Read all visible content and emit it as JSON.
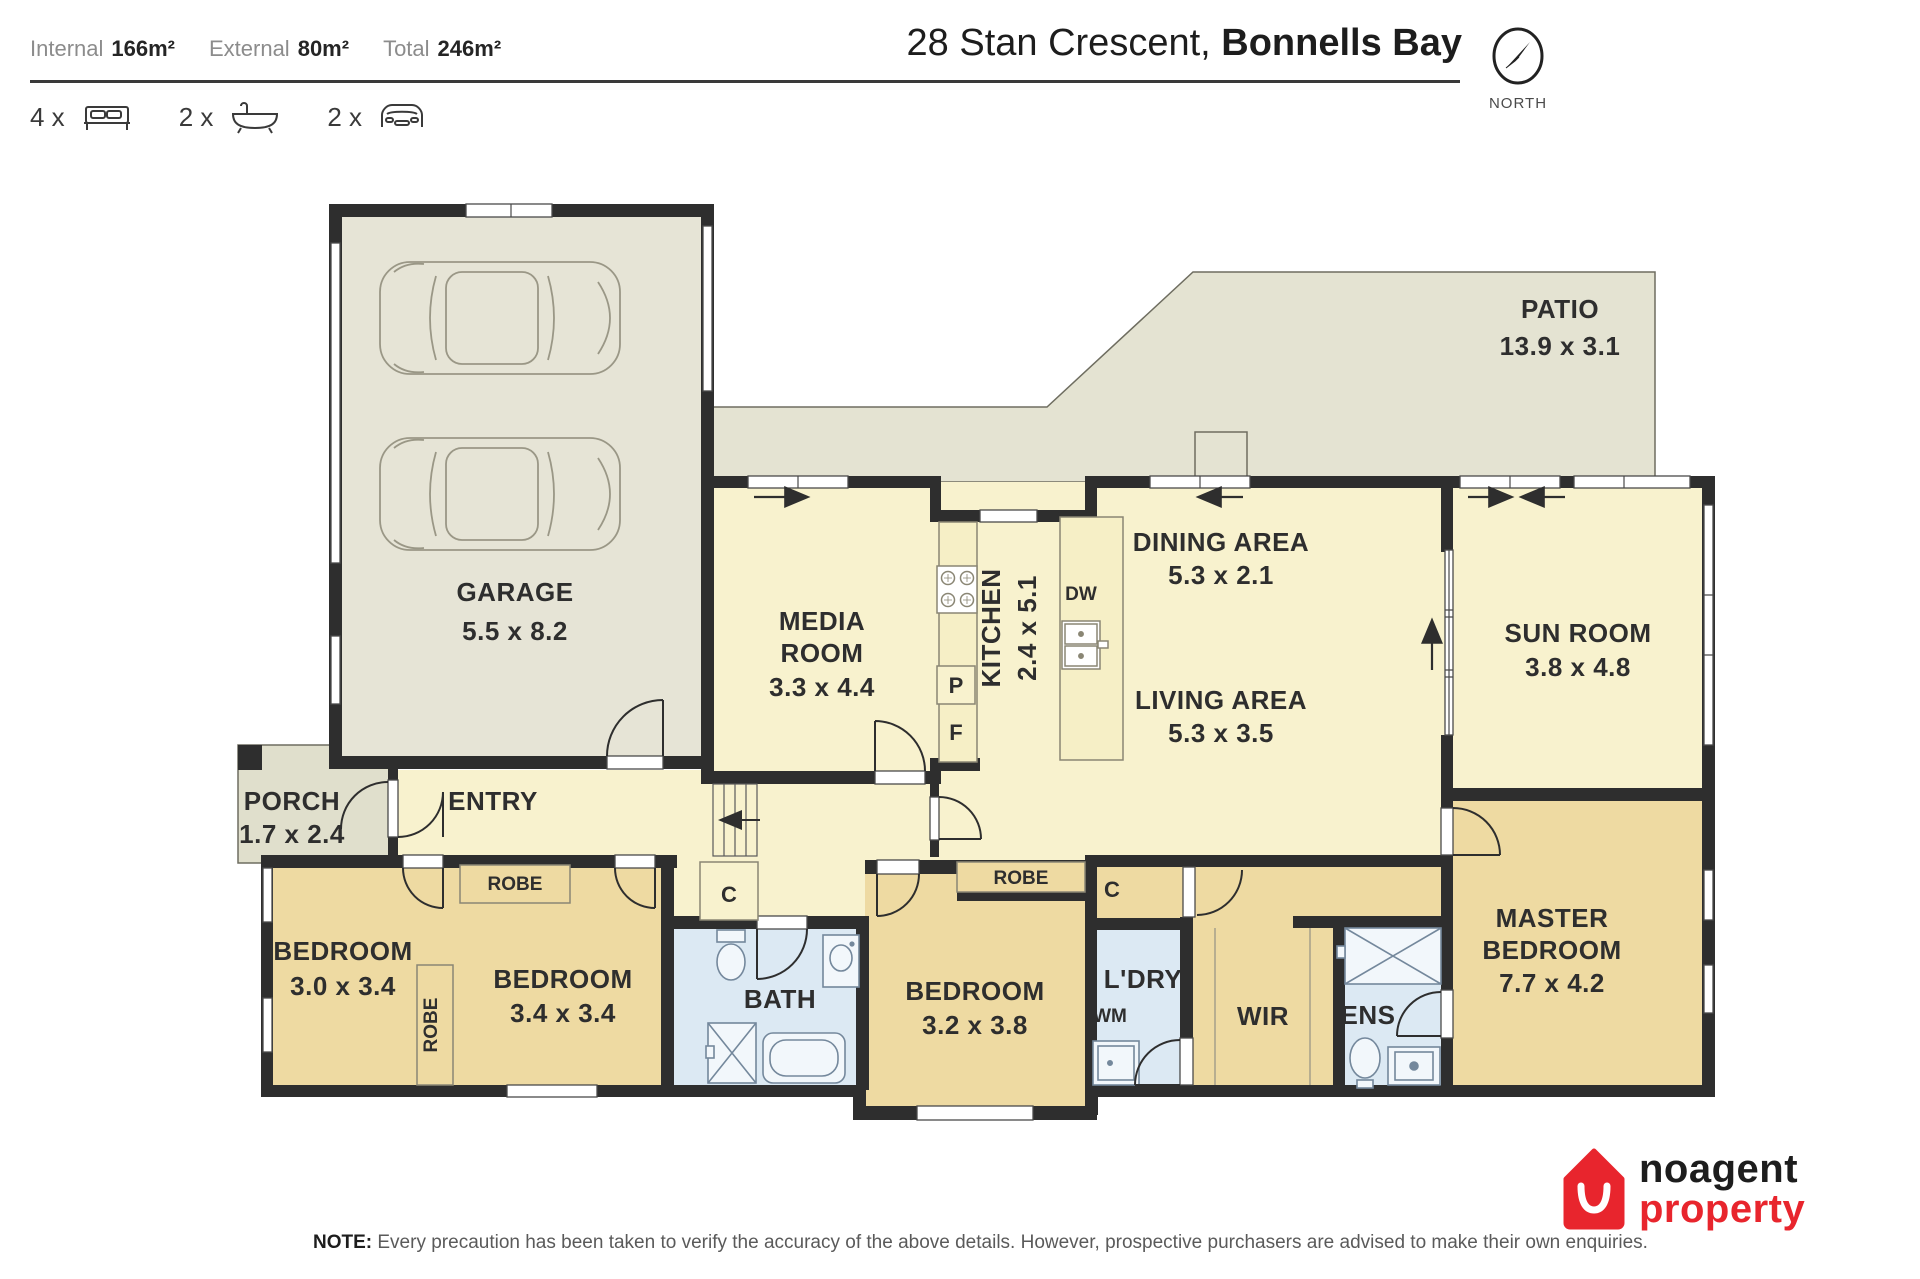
{
  "header": {
    "stats": [
      {
        "label": "Internal",
        "value": "166m²"
      },
      {
        "label": "External",
        "value": "80m²"
      },
      {
        "label": "Total",
        "value": "246m²"
      }
    ],
    "features": [
      {
        "count": "4 x",
        "icon": "bed-icon"
      },
      {
        "count": "2 x",
        "icon": "bath-icon"
      },
      {
        "count": "2 x",
        "icon": "car-icon"
      }
    ],
    "address_part1": "28 Stan Crescent, ",
    "address_part2": "Bonnells Bay",
    "compass_label": "NORTH"
  },
  "rooms": {
    "garage": {
      "name": "GARAGE",
      "dims": "5.5 x 8.2"
    },
    "patio": {
      "name": "PATIO",
      "dims": "13.9 x 3.1"
    },
    "porch": {
      "name": "PORCH",
      "dims": "1.7 x 2.4"
    },
    "entry": {
      "name": "ENTRY"
    },
    "media": {
      "line1": "MEDIA",
      "line2": "ROOM",
      "dims": "3.3 x 4.4"
    },
    "kitchen": {
      "name": "KITCHEN",
      "dims": "2.4 x 5.1"
    },
    "dining": {
      "name": "DINING AREA",
      "dims": "5.3 x 2.1"
    },
    "living": {
      "name": "LIVING AREA",
      "dims": "5.3 x 3.5"
    },
    "sunroom": {
      "name": "SUN ROOM",
      "dims": "3.8 x 4.8"
    },
    "master": {
      "line1": "MASTER",
      "line2": "BEDROOM",
      "dims": "7.7 x 4.2"
    },
    "bedroom1": {
      "name": "BEDROOM",
      "dims": "3.0 x 3.4"
    },
    "bedroom2": {
      "name": "BEDROOM",
      "dims": "3.4 x 3.4"
    },
    "bedroom3": {
      "name": "BEDROOM",
      "dims": "3.2 x 3.8"
    },
    "bath": {
      "name": "BATH"
    },
    "laundry": {
      "name": "L'DRY",
      "wm": "WM"
    },
    "wir": {
      "name": "WIR"
    },
    "ens": {
      "name": "ENS"
    }
  },
  "fixtures": {
    "robe": "ROBE",
    "cupboard": "C",
    "pantry": "P",
    "fridge": "F",
    "dishwasher": "DW"
  },
  "colors": {
    "wall": "#2e2e2e",
    "interior": "#f8f2ce",
    "bedroom": "#eedaa2",
    "wet_area": "#dce9f3",
    "external": "#e4e3d2",
    "logo_red": "#e8252d"
  },
  "footer": {
    "note_label": "NOTE:",
    "note_text": " Every precaution has been taken to verify the accuracy of the above details. However, prospective purchasers are advised to make their own enquiries.",
    "logo_line1": "noagent",
    "logo_line2": "property"
  }
}
